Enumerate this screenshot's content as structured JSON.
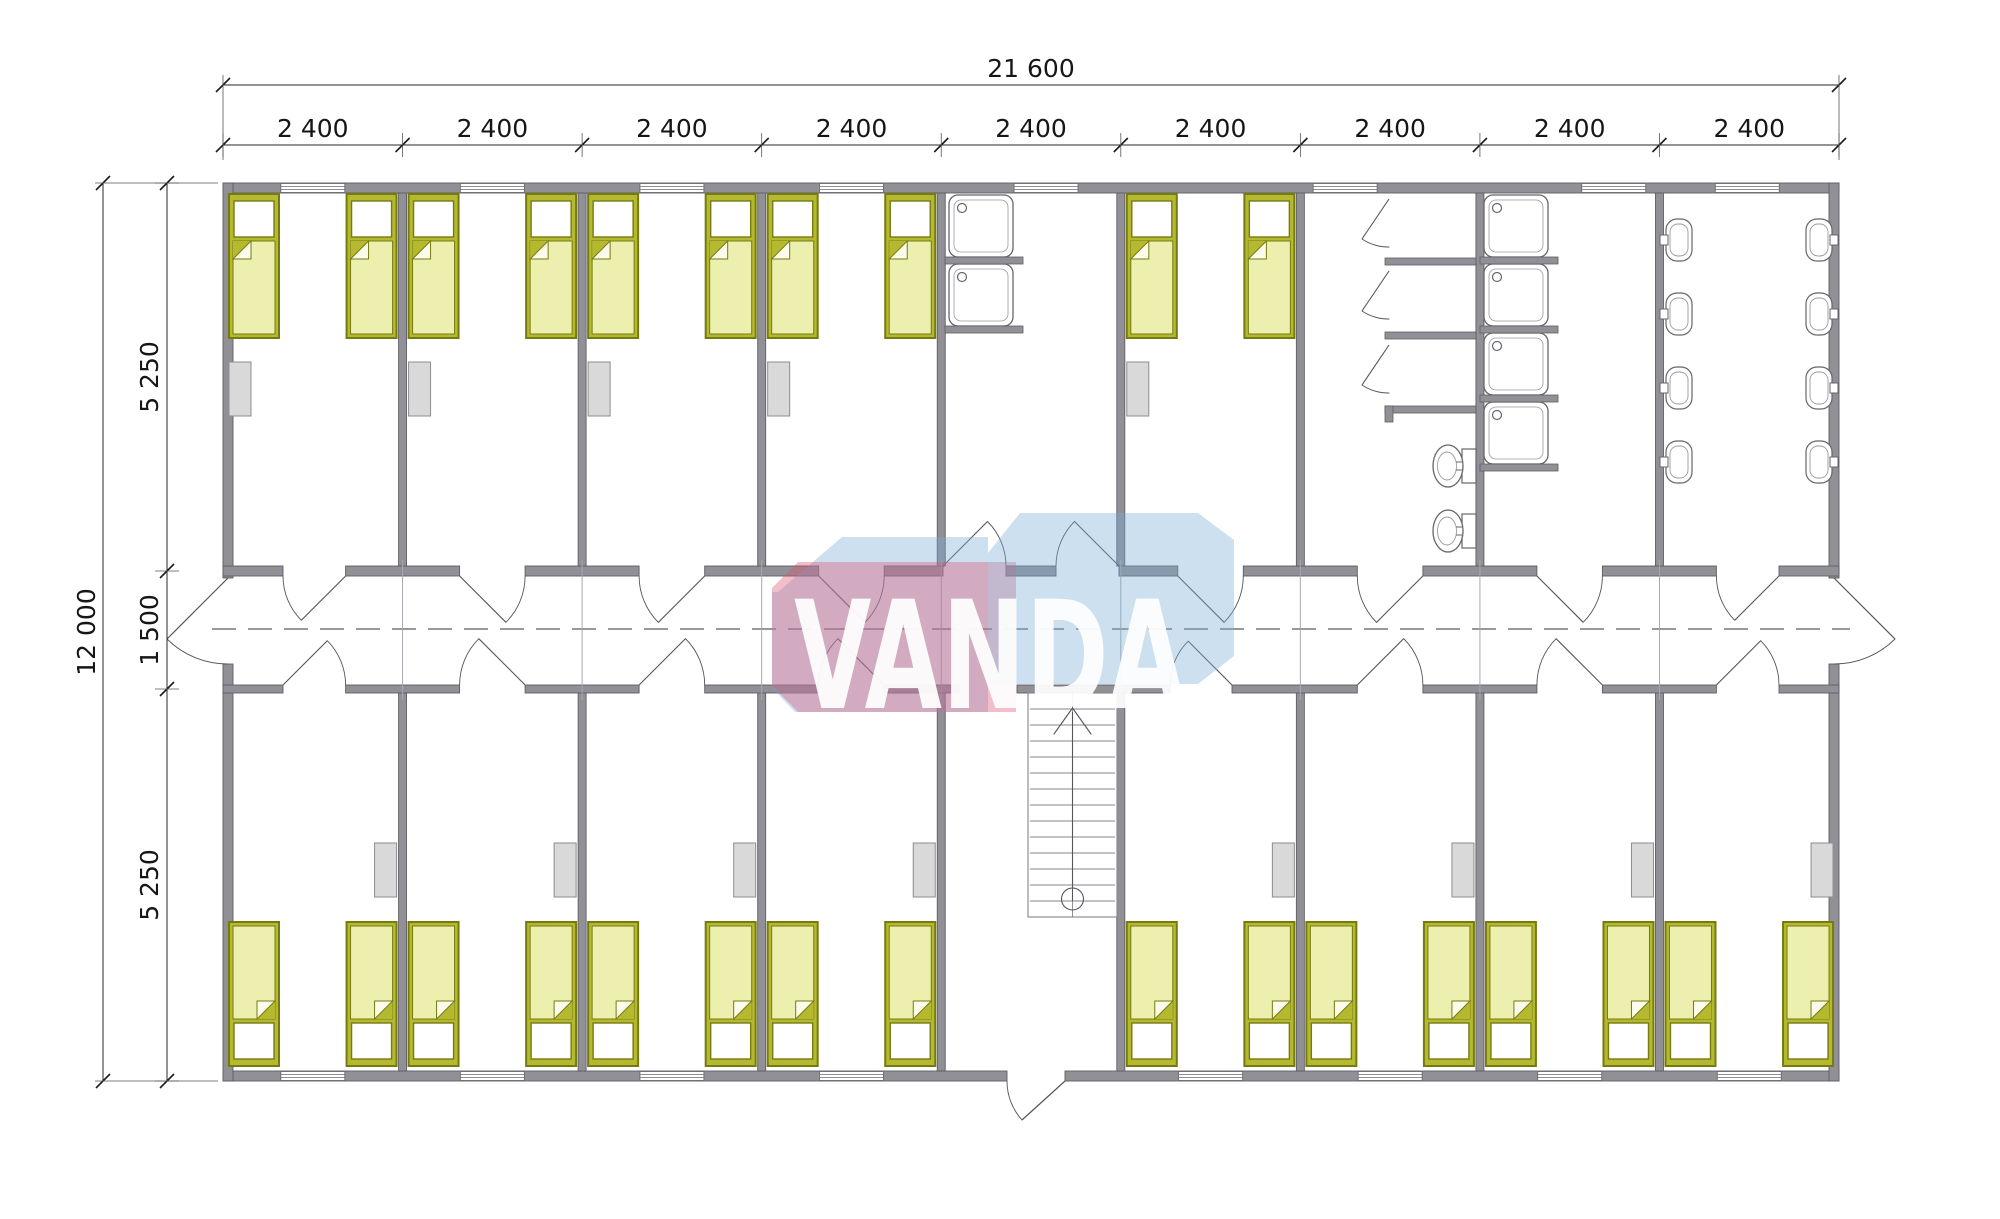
{
  "page": {
    "background": "#ffffff",
    "type": "architectural-floor-plan"
  },
  "dimensions": {
    "top_total": "21 600",
    "top_segments": [
      "2 400",
      "2 400",
      "2 400",
      "2 400",
      "2 400",
      "2 400",
      "2 400",
      "2 400",
      "2 400"
    ],
    "left_total": "12 000",
    "left_segments": [
      "5 250",
      "1 500",
      "5 250"
    ]
  },
  "watermark": {
    "text": "VANDA",
    "red": "#dd5471",
    "blue": "#7aaed8",
    "text_color": "#ffffff"
  },
  "plan": {
    "colors": {
      "wall": "#909096",
      "wall_edge": "#5e5e64",
      "bed_base": "#b4b92f",
      "bed_border": "#767b10",
      "blanket": "#edefae",
      "pillow": "#ffffff",
      "wardrobe": "#d9d9d9",
      "fixture_stroke": "#66666c",
      "dim_text": "#161616",
      "axis": "#77777c"
    },
    "rooms": {
      "top_row": [
        "bedroom",
        "bedroom",
        "bedroom",
        "bedroom",
        "washroom",
        "bedroom",
        "wc-room",
        "shower-room",
        "washbasin-room"
      ],
      "bottom_row": [
        "bedroom",
        "bedroom",
        "bedroom",
        "bedroom",
        "stair-hall",
        "bedroom",
        "bedroom",
        "bedroom",
        "bedroom"
      ]
    },
    "fixtures": {
      "beds": 26,
      "wardrobes": 13,
      "windows": 16,
      "shower_trays": 6,
      "wc_stalls": 3,
      "wall_hung_toilets": 2,
      "washbasins": 8,
      "interior_doors": 18,
      "exterior_doors": 3,
      "staircases": 1
    }
  }
}
